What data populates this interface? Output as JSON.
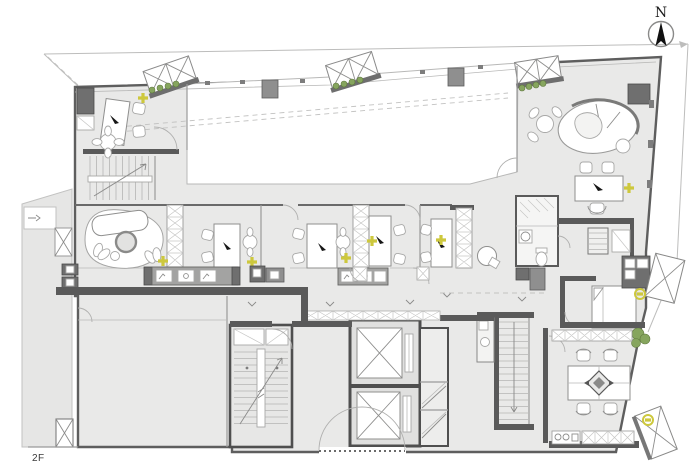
{
  "labels": {
    "floor": "2F",
    "compass_north": "N"
  },
  "palette": {
    "paper": "#ffffff",
    "floor": "#e9e9e8",
    "voidc": "#ffffff",
    "wall": "#5e5e5e",
    "wallLight": "#9a9a9a",
    "cabinet": "#8f8f8f",
    "cabinetDark": "#6f6f6f",
    "accentYellow": "#cdc83d",
    "plantGreen": "#86a55e",
    "boundary": "#bdbdbc"
  },
  "plan": {
    "floor_name": "2F",
    "drawing_type": "architectural floor plan",
    "elements": [
      {
        "name": "north-compass",
        "count": 1
      },
      {
        "name": "atrium-void-with-dashed-roof-line",
        "count": 1
      },
      {
        "name": "angled-bay-window",
        "count": 5
      },
      {
        "name": "window-planter-box",
        "count": 3
      },
      {
        "name": "private-office-with-desk",
        "count": 5
      },
      {
        "name": "lounge-organic-sofa",
        "count": 2
      },
      {
        "name": "round-table-with-chairs",
        "count": 4
      },
      {
        "name": "executive-desk",
        "count": 1
      },
      {
        "name": "storage-partition-wall",
        "count": 3
      },
      {
        "name": "printer-cabinet-row",
        "count": 2
      },
      {
        "name": "staircase",
        "count": 4
      },
      {
        "name": "elevator-shaft",
        "count": 2
      },
      {
        "name": "wc-toilet",
        "count": 1
      },
      {
        "name": "wash-basin",
        "count": 1
      },
      {
        "name": "meeting-table",
        "count": 1
      },
      {
        "name": "kitchenette-counter",
        "count": 1
      },
      {
        "name": "potted-plant",
        "count": 1
      },
      {
        "name": "power-outlet-symbol",
        "count": 7
      },
      {
        "name": "ceiling-light-symbol",
        "count": 2
      },
      {
        "name": "double-entry-door",
        "count": 1
      }
    ]
  }
}
